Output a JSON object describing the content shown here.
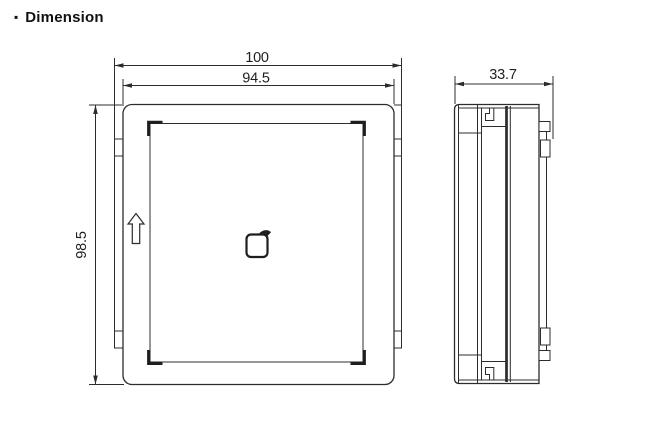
{
  "title": {
    "bullet": "▪",
    "text": "Dimension"
  },
  "views": {
    "front": {
      "name": "front-view",
      "dim_width_outer": "100",
      "dim_width_inner": "94.5",
      "dim_height": "98.5"
    },
    "side": {
      "name": "side-view",
      "dim_depth": "33.7"
    }
  },
  "icons": {
    "center_icon": "card-tap-icon",
    "orientation_icon": "up-arrow-icon"
  },
  "colors": {
    "background": "#ffffff",
    "line": "#2c2c2c",
    "text": "#1f1f1f"
  }
}
